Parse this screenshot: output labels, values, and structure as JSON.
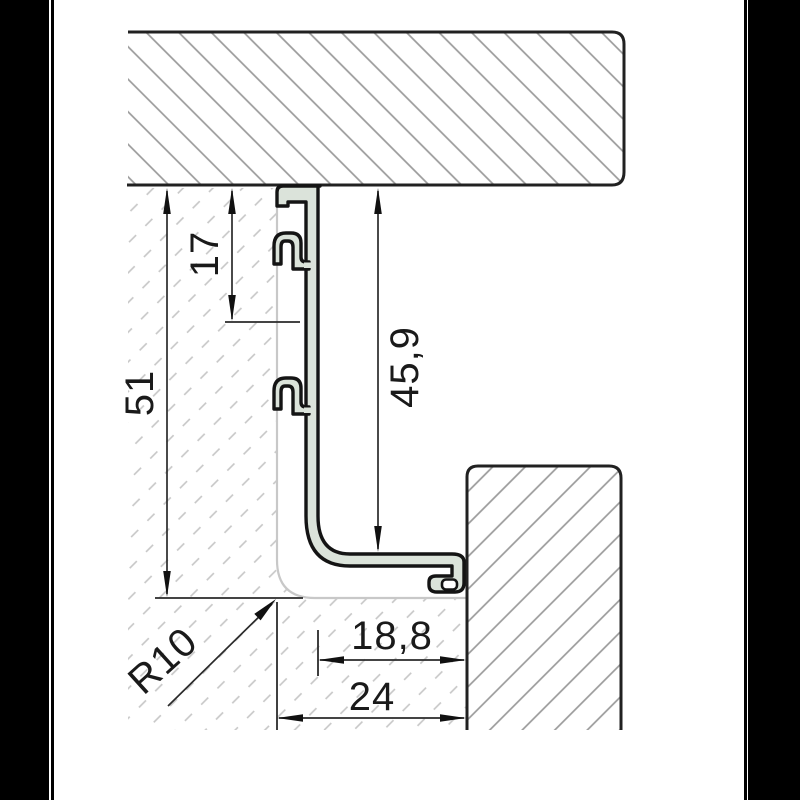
{
  "drawing": {
    "type": "technical-cross-section",
    "description": "Aluminium gola handle profile cross-section between two hatched panels",
    "dimensions": {
      "d51": "51",
      "d17": "17",
      "d459": "45,9",
      "d188": "18,8",
      "d24": "24",
      "r10": "R10"
    },
    "colors": {
      "background": "#000000",
      "paper": "#ffffff",
      "profile_fill": "#dbe3da",
      "profile_outline": "#141414",
      "panel_outline": "#212121",
      "panel_hatch": "#9a9a9a",
      "phantom_line": "#c8c8c8",
      "background_hatch": "#c6c6c6",
      "dimension_line": "#2a2a2a"
    }
  }
}
